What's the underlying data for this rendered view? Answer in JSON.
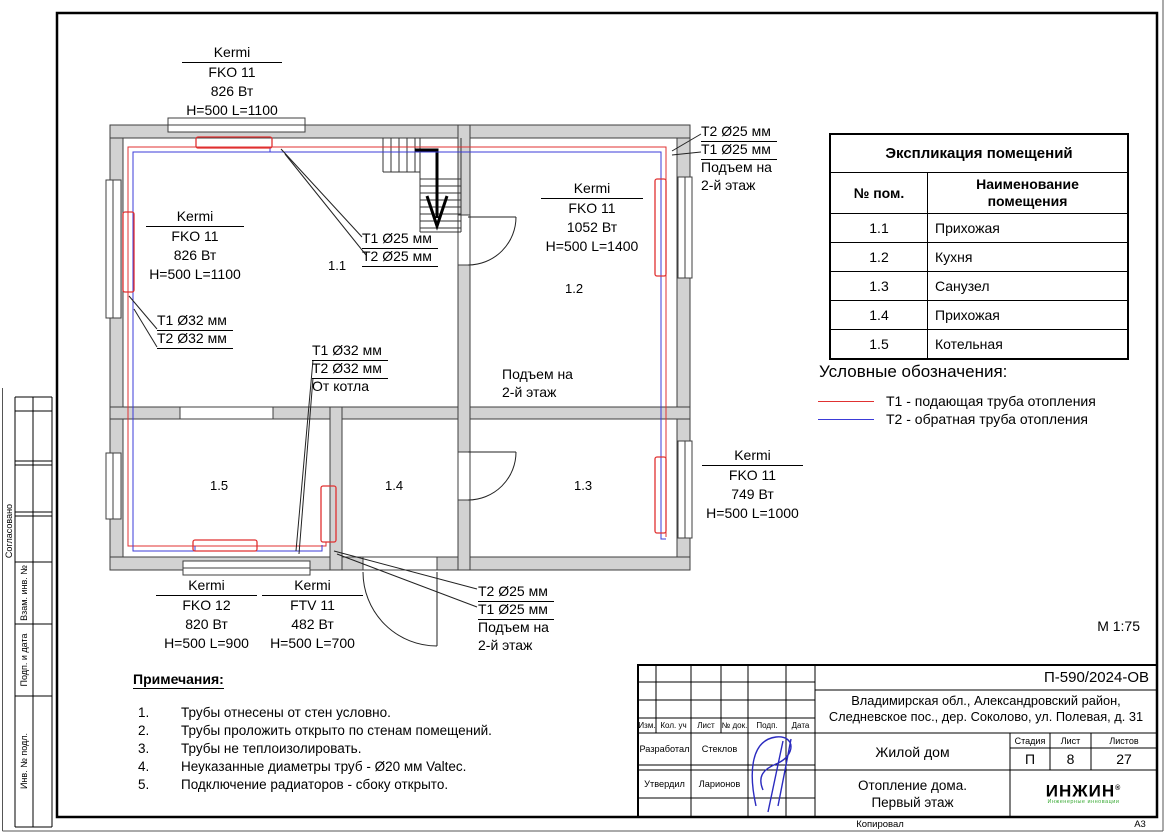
{
  "sheet": {
    "scale": "М 1:75",
    "format": "А3",
    "copied_by": "Копировал"
  },
  "margin_labels": {
    "approved": "Согласовано",
    "subst_inv": "Взам. инв. №",
    "sign_date": "Подп. и дата",
    "inv_orig": "Инв. № подл."
  },
  "plan": {
    "room_numbers": [
      "1.1",
      "1.2",
      "1.3",
      "1.4",
      "1.5"
    ],
    "radiators": [
      {
        "brand": "Kermi",
        "model": "FKO 11",
        "power": "826 Вт",
        "size": "H=500 L=1100"
      },
      {
        "brand": "Kermi",
        "model": "FKO 11",
        "power": "826 Вт",
        "size": "H=500 L=1100"
      },
      {
        "brand": "Kermi",
        "model": "FKO 11",
        "power": "1052 Вт",
        "size": "H=500 L=1400"
      },
      {
        "brand": "Kermi",
        "model": "FKO 11",
        "power": "749 Вт",
        "size": "H=500 L=1000"
      },
      {
        "brand": "Kermi",
        "model": "FKO 12",
        "power": "820 Вт",
        "size": "H=500 L=900"
      },
      {
        "brand": "Kermi",
        "model": "FTV 11",
        "power": "482 Вт",
        "size": "H=500 L=700"
      }
    ],
    "pipe_labels": {
      "t1_25": "T1 Ø25 мм",
      "t2_25": "T2 Ø25 мм",
      "t1_32": "T1 Ø32 мм",
      "t2_32": "T2 Ø32 мм",
      "from_boiler": "От котла",
      "rise_1": "Подъем на",
      "rise_2": "2-й этаж"
    },
    "pipe_colors": {
      "t1_supply": "#e03131",
      "t2_return": "#3b3bd8"
    }
  },
  "explication": {
    "title": "Экспликация помещений",
    "col1": "№ пом.",
    "col2_line1": "Наименование",
    "col2_line2": "помещения",
    "rows": [
      {
        "num": "1.1",
        "name": "Прихожая"
      },
      {
        "num": "1.2",
        "name": "Кухня"
      },
      {
        "num": "1.3",
        "name": "Санузел"
      },
      {
        "num": "1.4",
        "name": "Прихожая"
      },
      {
        "num": "1.5",
        "name": "Котельная"
      }
    ]
  },
  "legend": {
    "title": "Условные обозначения:",
    "items": [
      {
        "label": "Т1 - подающая труба отопления",
        "color": "#e03131"
      },
      {
        "label": "Т2 - обратная труба отопления",
        "color": "#3b3bd8"
      }
    ]
  },
  "notes": {
    "title": "Примечания:",
    "items": [
      {
        "n": "1.",
        "text": "Трубы отнесены от стен условно."
      },
      {
        "n": "2.",
        "text": "Трубы проложить открыто по стенам помещений."
      },
      {
        "n": "3.",
        "text": "Трубы не теплоизолировать."
      },
      {
        "n": "4.",
        "text": "Неуказанные диаметры труб - Ø20 мм Valtec."
      },
      {
        "n": "5.",
        "text": "Подключение радиаторов - сбоку открыто."
      }
    ]
  },
  "title_block": {
    "doc_number": "П-590/2024-ОВ",
    "address_1": "Владимирская обл., Александровский район,",
    "address_2": "Следневское пос., дер. Соколово, ул. Полевая, д. 31",
    "object": "Жилой дом",
    "drawing_1": "Отопление дома.",
    "drawing_2": "Первый этаж",
    "cols": {
      "izm": "Изм.",
      "kol": "Кол. уч",
      "list": "Лист",
      "doc": "№ док.",
      "podp": "Подп.",
      "data": "Дата"
    },
    "stage_h": "Стадия",
    "list_h": "Лист",
    "listov_h": "Листов",
    "stage": "П",
    "list": "8",
    "listov": "27",
    "developed_label": "Разработал",
    "developed_name": "Стеклов",
    "approved_label": "Утвердил",
    "approved_name": "Ларионов",
    "logo": "ИНЖИН",
    "logo_reg": "®",
    "logo_tag": "Инженерные инновации"
  }
}
